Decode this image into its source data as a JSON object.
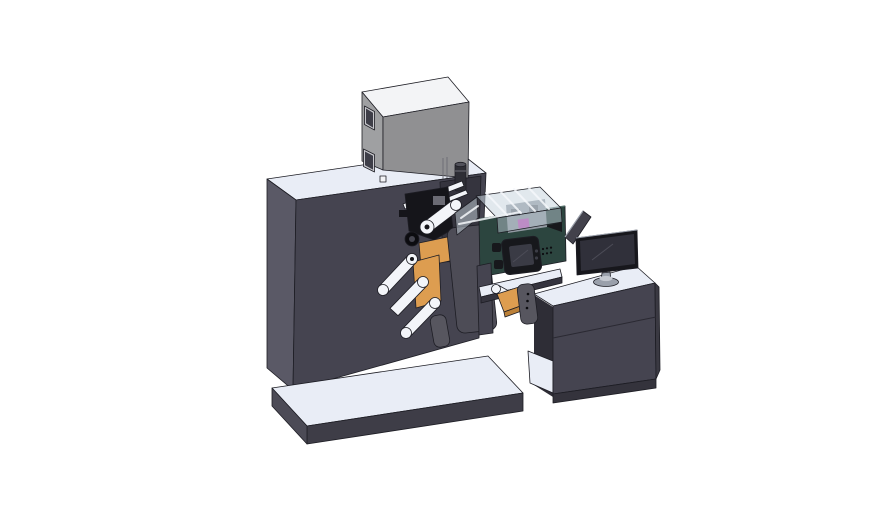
{
  "scene": {
    "description": "3D CAD render of an industrial label printing machine with roll mechanism, control module and operator desk with monitor",
    "background": "#ffffff"
  },
  "colors": {
    "background": "#ffffff",
    "top_surface": "#e9edf6",
    "machine_front": "#454450",
    "machine_left": "#5a5966",
    "machine_bay": "#35343e",
    "platform_front": "#3e3d47",
    "platform_left": "#4c4b56",
    "box_front": "#909092",
    "box_left": "#9fa0a2",
    "box_top": "#f3f4f6",
    "window_glass": "#3e3e48",
    "window_frame": "#c8c8cd",
    "cylinder_body": "#2e2e35",
    "cylinder_cap": "#52525b",
    "mech_black": "#15151a",
    "mech_gray": "#6b6b74",
    "gear_dark": "#0c0c10",
    "gear_hub": "#45454f",
    "orange": "#dd9d50",
    "orange_dark": "#bb8038",
    "roller_white": "#f3f5f9",
    "cover_panel": "#4d4c56",
    "small_plate": "#57565f",
    "green_body": "#2c453f",
    "inner_mech": "#939aa3",
    "inner_mech_dark": "#60656e",
    "magenta": "#c455bc",
    "acrylic": "#c9d5de",
    "acrylic_front": "#b6c3ce",
    "hmi_bezel": "#17181c",
    "hmi_screen": "#3a3b45",
    "hmi_dot": "#3c3d46",
    "desk_front": "#454450",
    "desk_right": "#3a3942",
    "desk_plinth": "#34333c",
    "desk_interior": "#2e2d36",
    "monitor_bezel": "#17171c",
    "monitor_screen": "#30303a",
    "monitor_stand": "#9aa0ab",
    "monitor_cap": "#c4c8d0",
    "panel_dark": "#42414b",
    "white_tag": "#f2f3f6"
  },
  "parts": {
    "base_platform": "base platform",
    "main_cabinet": "main cabinet",
    "top_box": "electrical box",
    "signal_cylinder": "cylindrical knob",
    "web_mechanism": "web roller mechanism",
    "ink_station": "print control module",
    "acrylic_cover": "clear cover",
    "hmi_screen": "control screen",
    "output_chute": "output chute",
    "operator_desk": "operator desk",
    "monitor": "monitor",
    "side_panel": "side panel"
  }
}
